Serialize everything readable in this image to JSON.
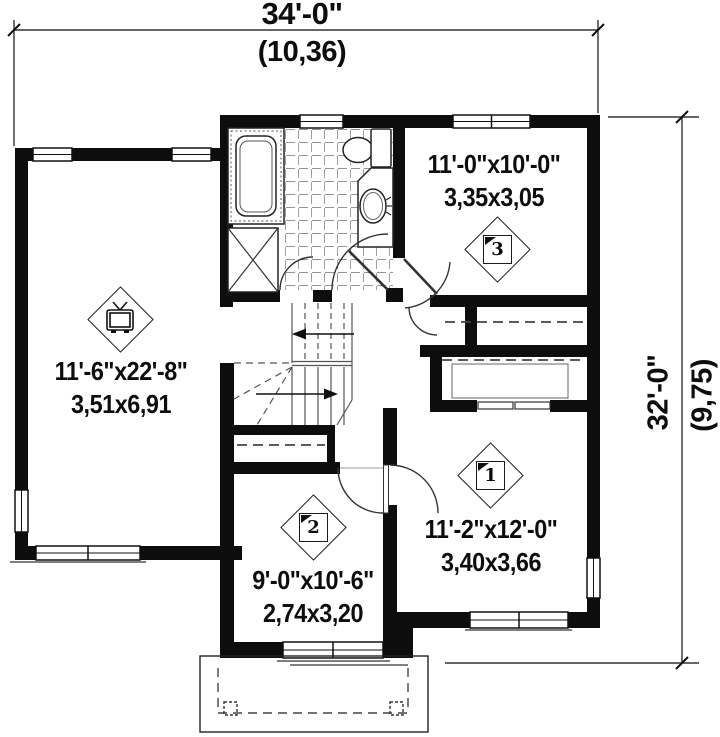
{
  "title": "Second floor plan",
  "dimensions": {
    "width": {
      "imperial": "34'-0\"",
      "metric": "(10,36)"
    },
    "depth": {
      "imperial": "32'-0\"",
      "metric": "(9,75)"
    }
  },
  "rooms": [
    {
      "key": "family-room",
      "imperial": "11'-6\"x22'-8\"",
      "metric": "3,51x6,91",
      "marker": "tv"
    },
    {
      "key": "bedroom-3",
      "imperial": "11'-0\"x10'-0\"",
      "metric": "3,35x3,05",
      "marker": "3"
    },
    {
      "key": "bedroom-1",
      "imperial": "11'-2\"x12'-0\"",
      "metric": "3,40x3,66",
      "marker": "1"
    },
    {
      "key": "bedroom-2",
      "imperial": "9'-0\"x10'-6\"",
      "metric": "2,74x3,20",
      "marker": "2"
    }
  ],
  "markers": {
    "bedroom3": "3",
    "bedroom1": "1",
    "bedroom2": "2",
    "family": "tv-icon"
  },
  "colors": {
    "wall": "#0d0d0d",
    "line": "#333333",
    "background": "#ffffff"
  }
}
